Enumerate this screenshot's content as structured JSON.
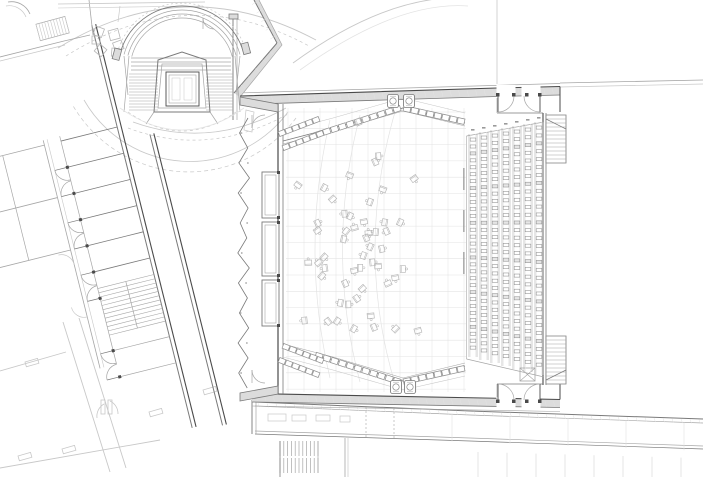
{
  "meta": {
    "title": "Architectural floor plan",
    "subject": "Concert hall orchestra-level plan: curved entry stair with central lift, diagonal room wing, stage with scattered orchestra chairs, angled choir rows with timpani, straight audience seating rows, service corridor below",
    "drawing_style": "CAD line drawing, grey on white"
  },
  "palette": {
    "background": "#ffffff",
    "wall_dark": "#4a4a4a",
    "wall_mid": "#7a7a7a",
    "line_light": "#a6a6a6",
    "line_faint": "#c8c8c8",
    "line_veryfaint": "#e3e3e3",
    "wall_fill": "#dcdcdc",
    "seat_stroke": "#8f8f8f",
    "chair_stroke": "#b6b6b6",
    "smudge": "#9a9a9a"
  },
  "plan": {
    "canvas": {
      "width": 703,
      "height": 477
    },
    "zones": [
      {
        "id": "amphitheater",
        "label": "Curved entry stair with central lift platform"
      },
      {
        "id": "office-wing",
        "label": "Diagonal room wing with corridor doors and stair"
      },
      {
        "id": "stage",
        "label": "Stage area with scattered orchestra chairs on grid"
      },
      {
        "id": "choir",
        "label": "Angled choir seat rows with timpani, top and bottom"
      },
      {
        "id": "audience",
        "label": "Straight audience seating rows, right side"
      },
      {
        "id": "service-corridor",
        "label": "Service corridor band below hall"
      },
      {
        "id": "parking",
        "label": "Faint parking bays, bottom right"
      },
      {
        "id": "lower-level",
        "label": "Faint lower-level walls, bottom left"
      }
    ],
    "counts": {
      "amphitheater_arcs": 4,
      "amphitheater_treads": 13,
      "wing_rooms": 9,
      "wing_doors": 8,
      "audience_seat_columns": 7,
      "audience_seats_per_column": 31,
      "orchestra_chairs": 52,
      "choir_seats_top_left": 11,
      "choir_seats_top_right": 8,
      "choir_seats_bottom_left": 11,
      "choir_seats_bottom_right": 8,
      "side_row_seats": 6,
      "timpani": 4,
      "right_stair_treads": 12,
      "corridor_stair_treads": 10,
      "parking_bays": 8,
      "wall_panels": 3
    }
  }
}
